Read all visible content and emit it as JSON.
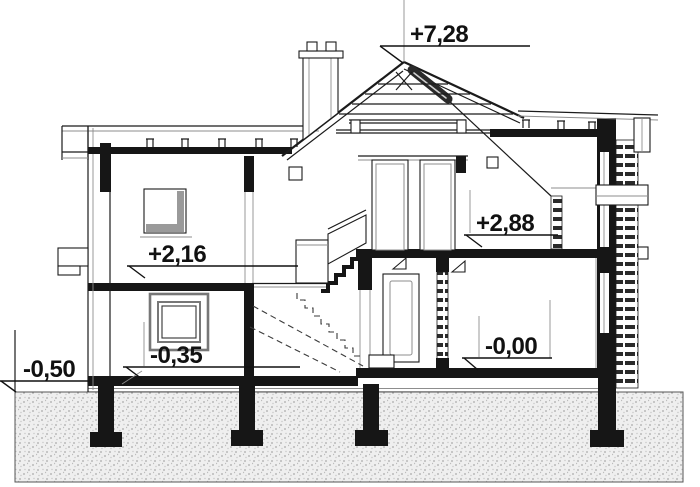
{
  "levels": {
    "ridge": "+7,28",
    "upper_floor_right": "+2,88",
    "upper_floor_left": "+2,16",
    "lower_floor_left": "-0,35",
    "lower_floor_right": "-0,00",
    "exterior_grade": "-0,50"
  },
  "colors": {
    "line": "#1b1b1b",
    "dark_fill": "#161616",
    "gray": "#8d8d8d",
    "ground_bg": "#efefef",
    "ground_dot": "#a8a8a8"
  }
}
